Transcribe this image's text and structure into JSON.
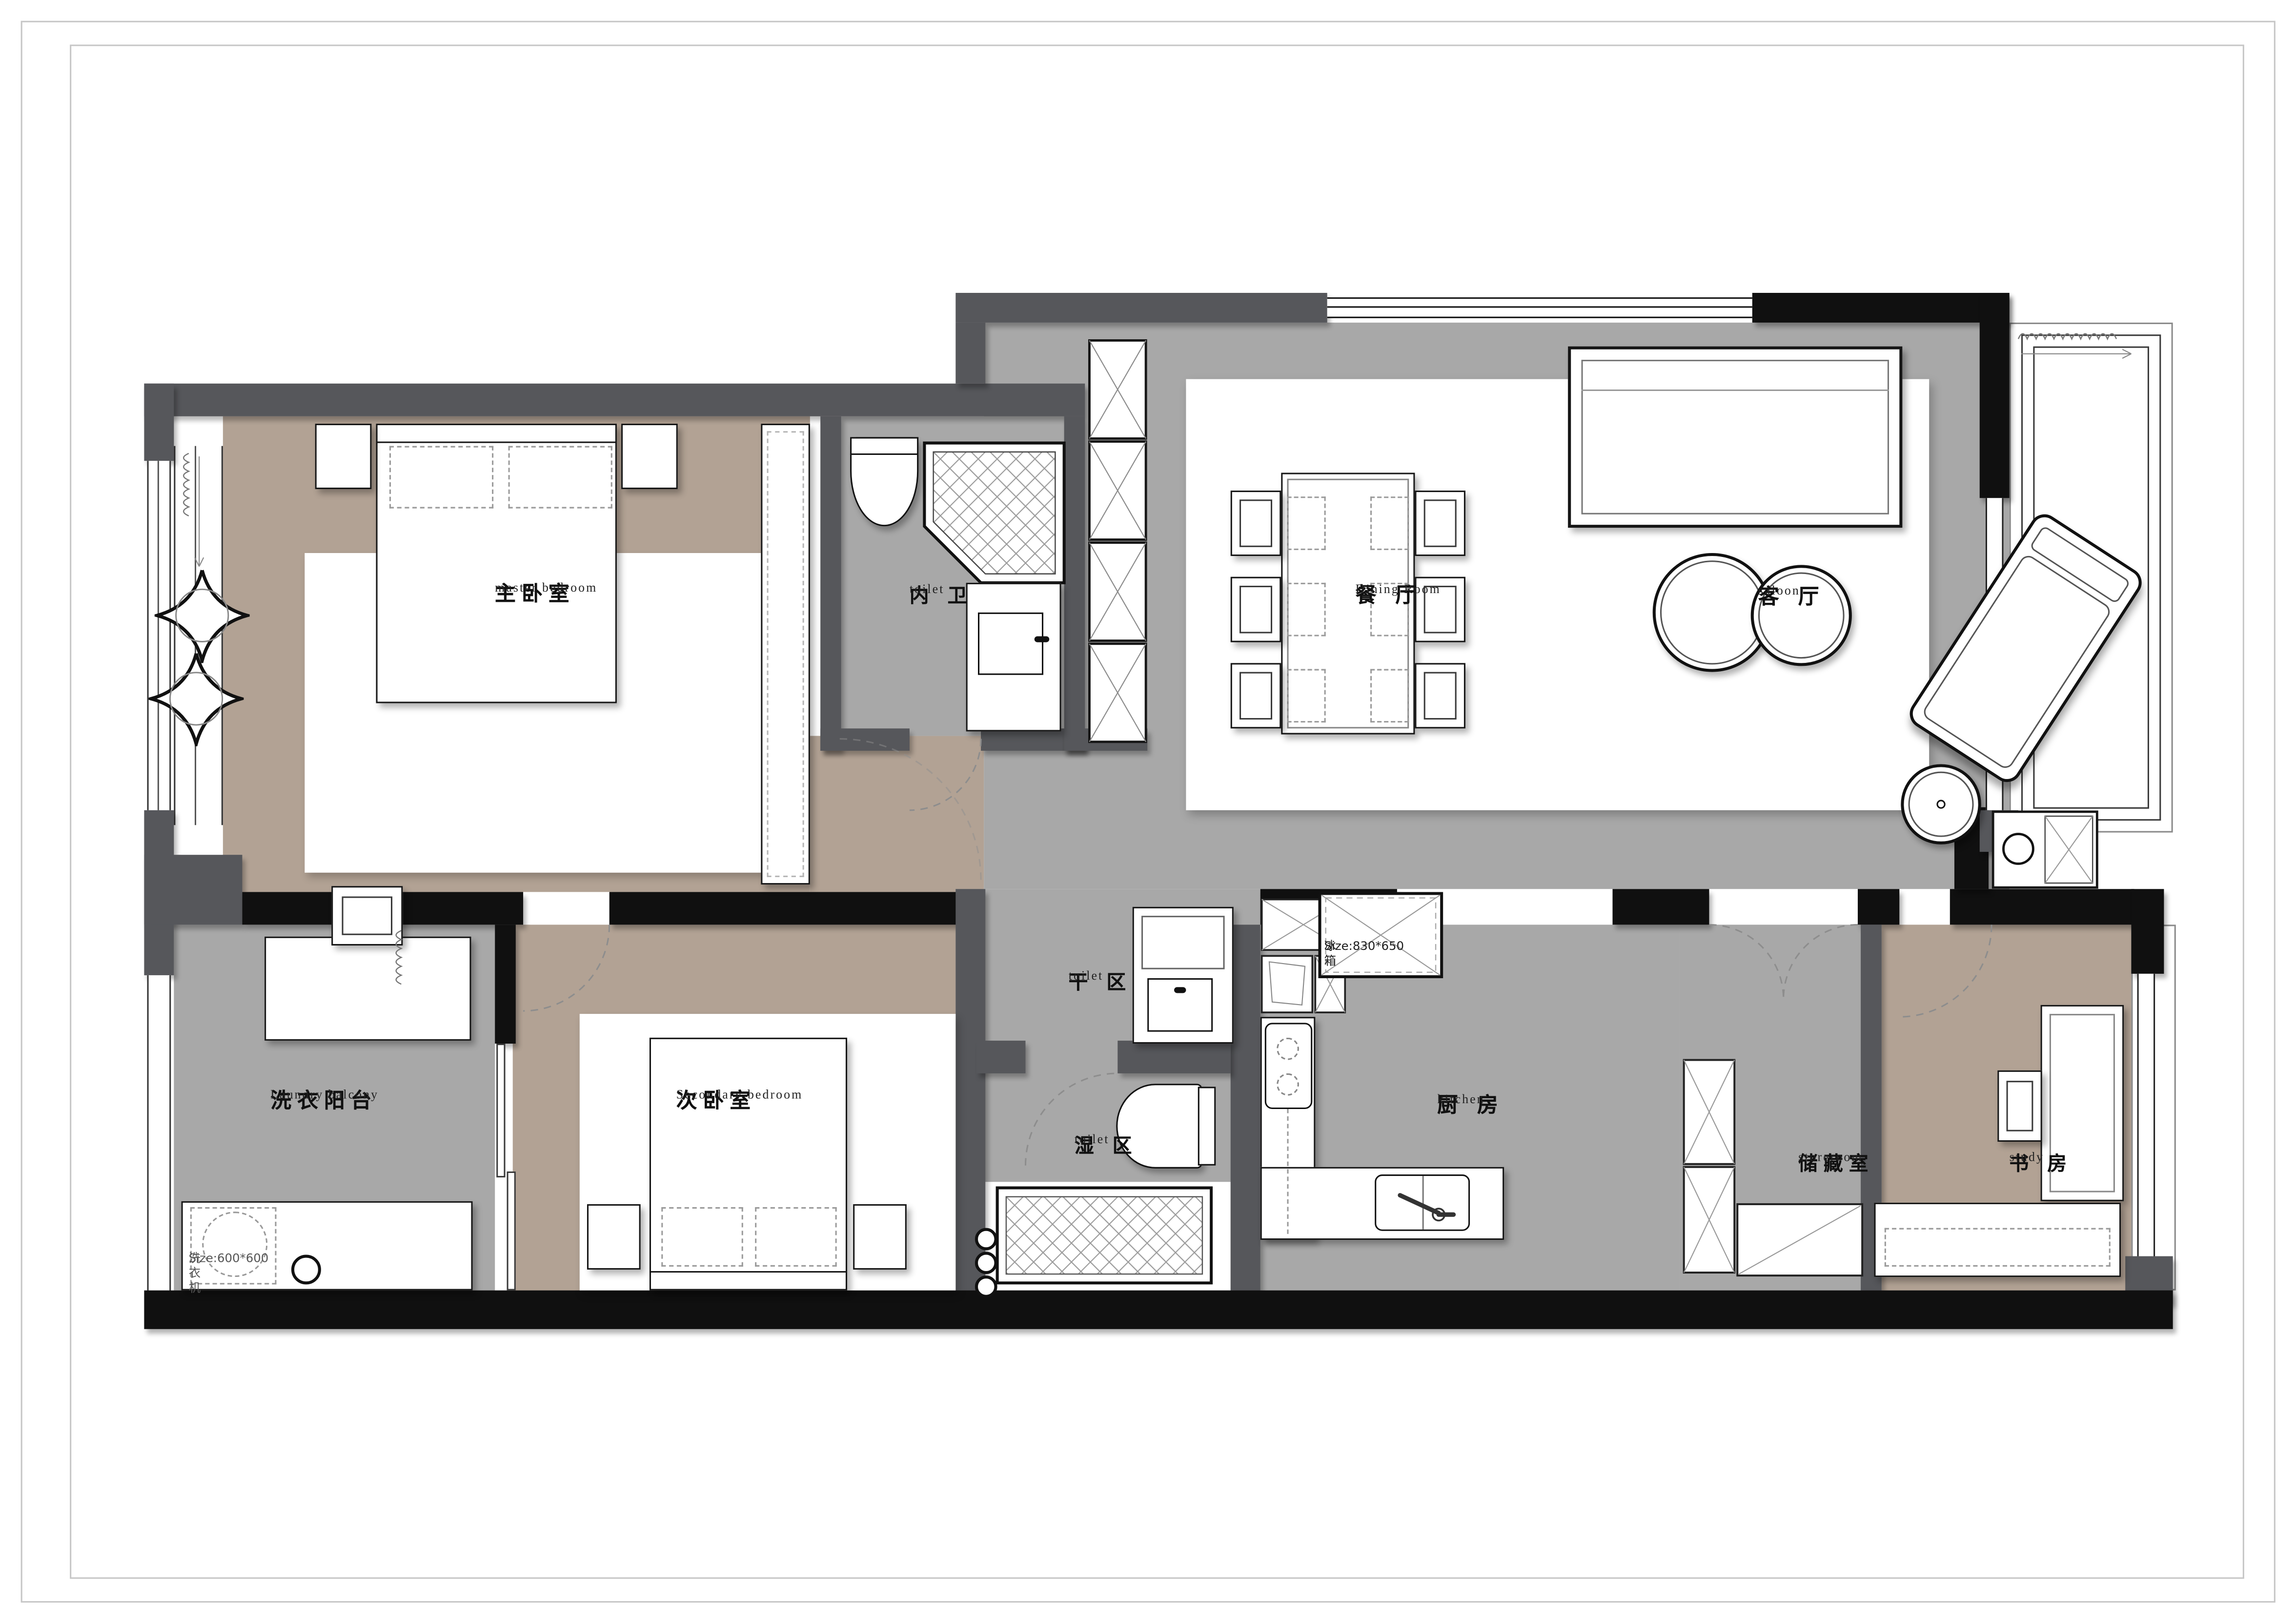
{
  "document": {
    "kind": "residential floor plan"
  },
  "rooms": [
    {
      "id": "master-bedroom",
      "cn": "主卧室",
      "en": "master bedroom"
    },
    {
      "id": "ensuite-toilet",
      "cn": "内 卫",
      "en": "toilet"
    },
    {
      "id": "dining-room",
      "cn": "餐 厅",
      "en": "Dining Room"
    },
    {
      "id": "living-room",
      "cn": "客 厅",
      "en": "saloon"
    },
    {
      "id": "dry-area",
      "cn": "干 区",
      "en": "toilet"
    },
    {
      "id": "wet-area",
      "cn": "湿 区",
      "en": "toilet"
    },
    {
      "id": "kitchen",
      "cn": "厨 房",
      "en": "kitchen"
    },
    {
      "id": "laundry-balcony",
      "cn": "洗衣阳台",
      "en": "Laundry balcony"
    },
    {
      "id": "secondary-bedroom",
      "cn": "次卧室",
      "en": "Secondary bedroom"
    },
    {
      "id": "storeroom",
      "cn": "储藏室",
      "en": "storeroom"
    },
    {
      "id": "study",
      "cn": "书 房",
      "en": "study"
    }
  ],
  "appliances": [
    {
      "id": "fridge",
      "label": "冰箱",
      "size": "Size:830*650"
    },
    {
      "id": "washing-machine",
      "label": "洗衣机",
      "size": "Size:600*600"
    }
  ],
  "colors": {
    "wall_black": "#101010",
    "wall_gray": "#56575b",
    "floor_gray": "#a8a8a8",
    "floor_tan": "#b2a294",
    "paper": "#ffffff"
  }
}
